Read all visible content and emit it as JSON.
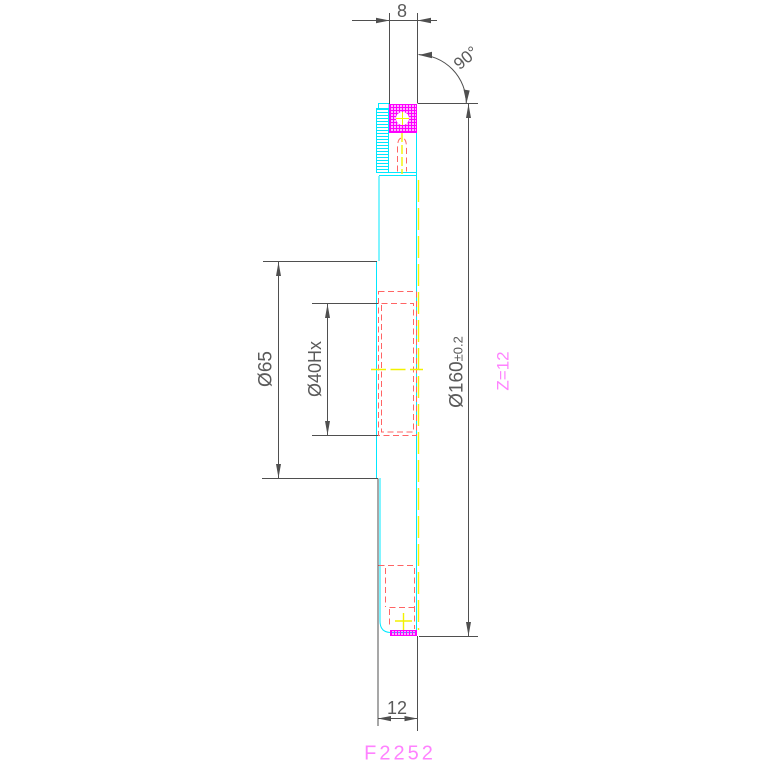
{
  "drawing": {
    "part_number": "F2252",
    "dimensions": {
      "top_width": "8",
      "angle": "90°",
      "boss_diameter": "Ø65",
      "bore_diameter": "Ø40Hx",
      "outer_diameter_main": "Ø160",
      "outer_diameter_tolerance": "±0.2",
      "bottom_thickness": "12",
      "teeth_label": "Z=12"
    },
    "colors": {
      "line": "#4f4f4f",
      "text": "#5a5a5a",
      "cyan": "#00e8ff",
      "magenta": "#ff00ff",
      "pink": "#ff82ff",
      "red": "#ff6464",
      "yellow": "#f2f200",
      "bg": "#ffffff"
    }
  }
}
